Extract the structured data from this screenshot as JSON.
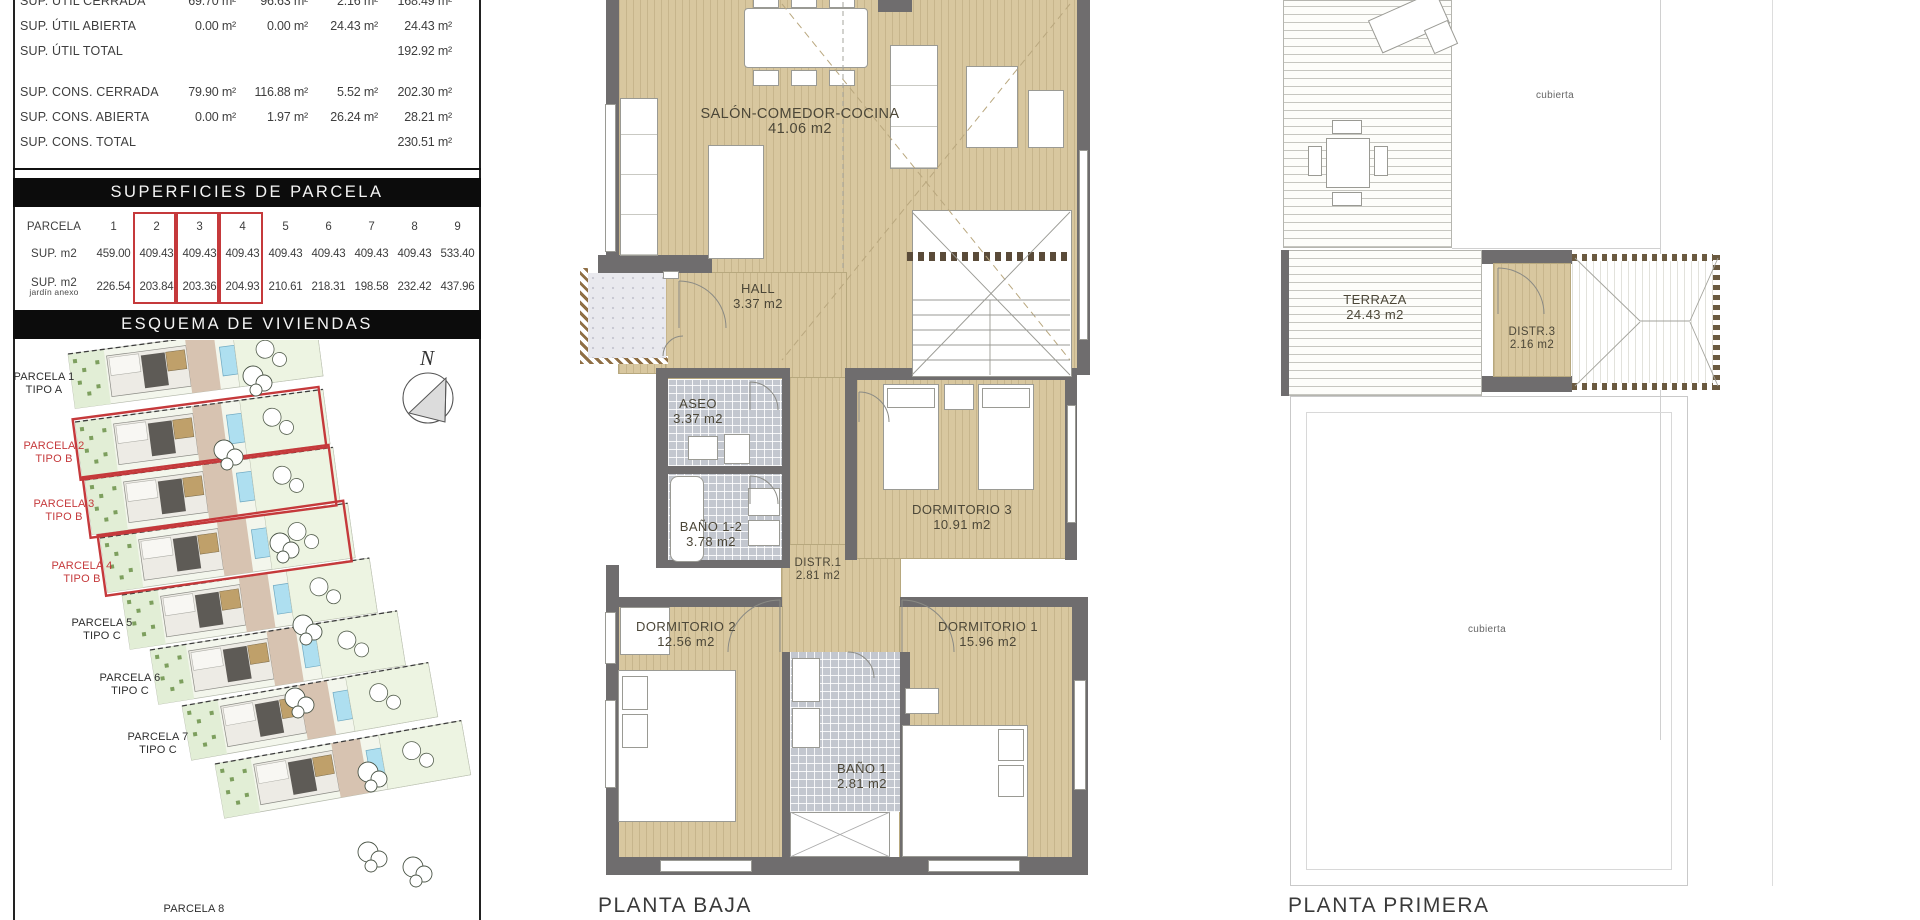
{
  "colors": {
    "highlight_red": "#c5393b",
    "floor_beige": "#d8c79f",
    "wall_gray": "#6f6d6e",
    "pool_blue": "#aedff0",
    "site_green": "#edf4e2",
    "tile_gray": "#c3c7cf"
  },
  "left_panel": {
    "surface_table": {
      "rows": [
        {
          "label": "SUP. ÚTIL CERRADA",
          "v1": "69.70 m²",
          "v2": "96.63 m²",
          "v3": "2.16 m²",
          "v4": "168.49 m²"
        },
        {
          "label": "SUP. ÚTIL ABIERTA",
          "v1": "0.00 m²",
          "v2": "0.00 m²",
          "v3": "24.43 m²",
          "v4": "24.43 m²"
        },
        {
          "label": "SUP. ÚTIL TOTAL",
          "v1": "",
          "v2": "",
          "v3": "",
          "v4": "192.92 m²"
        },
        {
          "label": "SUP. CONS. CERRADA",
          "v1": "79.90 m²",
          "v2": "116.88 m²",
          "v3": "5.52 m²",
          "v4": "202.30 m²"
        },
        {
          "label": "SUP. CONS. ABIERTA",
          "v1": "0.00 m²",
          "v2": "1.97 m²",
          "v3": "26.24 m²",
          "v4": "28.21 m²"
        },
        {
          "label": "SUP. CONS. TOTAL",
          "v1": "",
          "v2": "",
          "v3": "",
          "v4": "230.51 m²"
        }
      ]
    },
    "superficies_header": "SUPERFICIES DE PARCELA",
    "parcela_table": {
      "row_label": "PARCELA",
      "numbers": [
        "1",
        "2",
        "3",
        "4",
        "5",
        "6",
        "7",
        "8",
        "9"
      ],
      "sup_label": "SUP. m2",
      "sup_values": [
        "459.00",
        "409.43",
        "409.43",
        "409.43",
        "409.43",
        "409.43",
        "409.43",
        "409.43",
        "533.40"
      ],
      "jardin_label": "SUP. m2",
      "jardin_sublabel": "jardín anexo",
      "jardin_values": [
        "226.54",
        "203.84",
        "203.36",
        "204.93",
        "210.61",
        "218.31",
        "198.58",
        "232.42",
        "437.96"
      ]
    },
    "esquema_header": "ESQUEMA DE VIVIENDAS",
    "north_label": "N",
    "parcel_labels": [
      {
        "name": "PARCELA 1",
        "tipo": "TIPO A"
      },
      {
        "name": "PARCELA 2",
        "tipo": "TIPO B"
      },
      {
        "name": "PARCELA 3",
        "tipo": "TIPO B"
      },
      {
        "name": "PARCELA 4",
        "tipo": "TIPO B"
      },
      {
        "name": "PARCELA 5",
        "tipo": "TIPO C"
      },
      {
        "name": "PARCELA 6",
        "tipo": "TIPO C"
      },
      {
        "name": "PARCELA 7",
        "tipo": "TIPO C"
      },
      {
        "name": "PARCELA 8",
        "tipo": ""
      }
    ]
  },
  "planta_baja": {
    "title": "PLANTA BAJA",
    "rooms": {
      "salon": {
        "name": "SALÓN-COMEDOR-COCINA",
        "area": "41.06 m2"
      },
      "hall": {
        "name": "HALL",
        "area": "3.37 m2"
      },
      "aseo": {
        "name": "ASEO",
        "area": "3.37 m2"
      },
      "bano12": {
        "name": "BAÑO 1-2",
        "area": "3.78 m2"
      },
      "distr1": {
        "name": "DISTR.1",
        "area": "2.81 m2"
      },
      "dorm3": {
        "name": "DORMITORIO 3",
        "area": "10.91 m2"
      },
      "dorm2": {
        "name": "DORMITORIO 2",
        "area": "12.56 m2"
      },
      "dorm1": {
        "name": "DORMITORIO 1",
        "area": "15.96 m2"
      },
      "bano1": {
        "name": "BAÑO 1",
        "area": "2.81 m2"
      }
    }
  },
  "planta_primera": {
    "title": "PLANTA PRIMERA",
    "rooms": {
      "terraza": {
        "name": "TERRAZA",
        "area": "24.43 m2"
      },
      "distr3": {
        "name": "DISTR.3",
        "area": "2.16 m2"
      },
      "cubierta_top": "cubierta",
      "cubierta_bottom": "cubierta"
    }
  }
}
